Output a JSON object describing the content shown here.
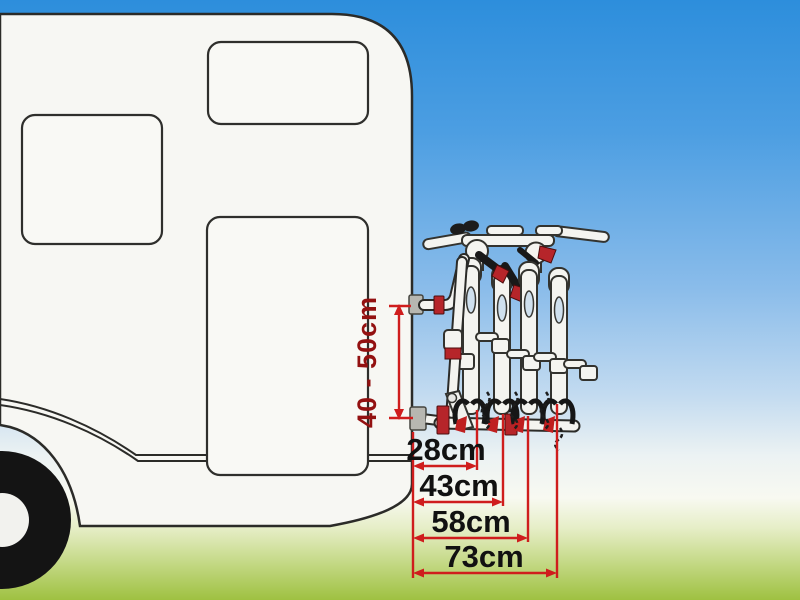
{
  "scene": {
    "subject": "caravan rear wall with 4-bike rear-mounted bicycle carrier, dimensioned",
    "elements": [
      "caravan-body",
      "caravan-windows",
      "caravan-wheel",
      "bike-carrier",
      "bike-forks",
      "dimension-lines"
    ]
  },
  "dimensions": {
    "vertical": {
      "label": "40 - 50cm",
      "min_cm": 40,
      "max_cm": 50,
      "unit": "cm"
    },
    "horizontal": [
      {
        "label": "28cm",
        "value_cm": 28
      },
      {
        "label": "43cm",
        "value_cm": 43
      },
      {
        "label": "58cm",
        "value_cm": 58
      },
      {
        "label": "73cm",
        "value_cm": 73
      }
    ]
  },
  "colors": {
    "sky_top": "#2d8edc",
    "sky_mid": "#8abcea",
    "horizon_white": "#f8f9f1",
    "grass_bottom": "#9fc141",
    "caravan_fill": "#f7f7f3",
    "outline_dark": "#2b2b28",
    "tube_white": "#f4f4f0",
    "accent_red": "#b6252a",
    "dimension_red": "#cf1d1d",
    "vertical_label_red": "#931111",
    "label_black": "#111111"
  }
}
